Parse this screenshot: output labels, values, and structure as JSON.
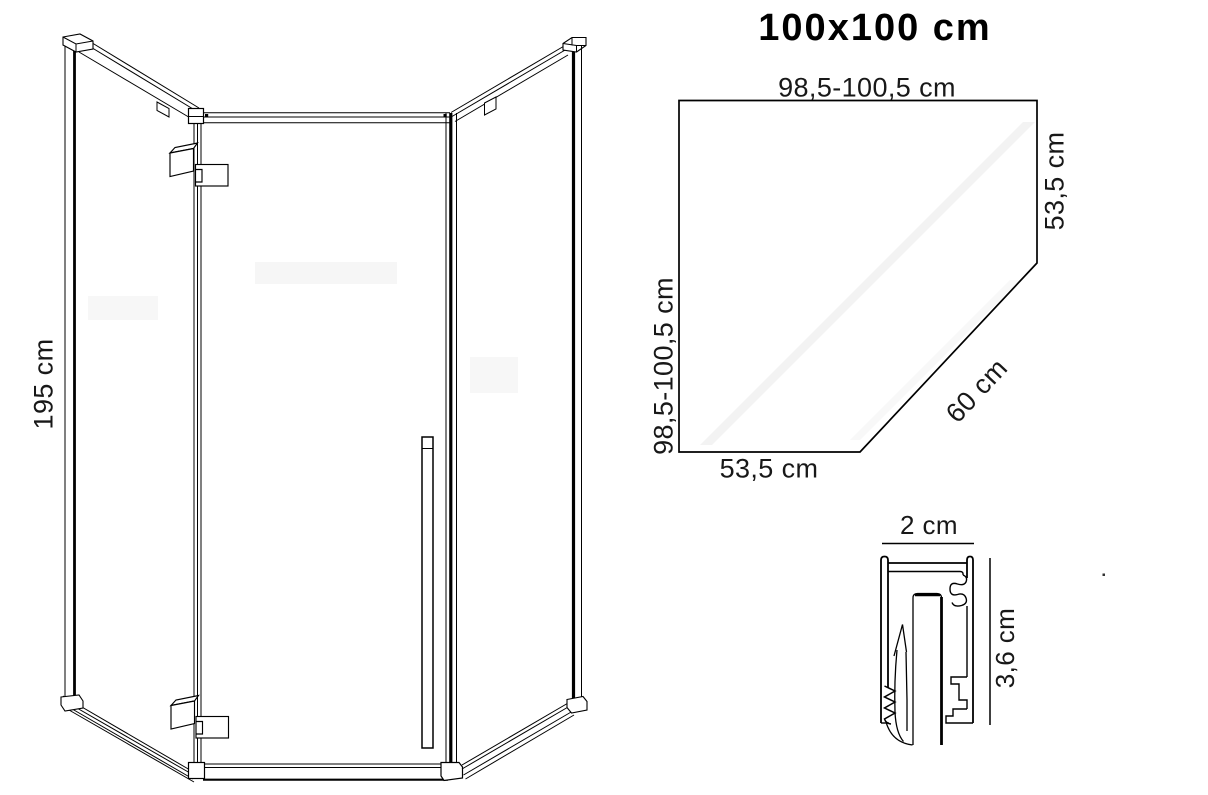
{
  "title": "100x100 cm",
  "side_view": {
    "height_label": "195 cm"
  },
  "floor_plan": {
    "width_top": "98,5-100,5 cm",
    "depth_left": "98,5-100,5 cm",
    "side_right": "53,5 cm",
    "door_diagonal": "60 cm",
    "side_bottom": "53,5 cm"
  },
  "profile": {
    "width": "2 cm",
    "depth": "3,6 cm"
  },
  "colors": {
    "line": "#000000",
    "text": "#181818",
    "background": "#ffffff",
    "glass_reflection": "#f3f3f3"
  }
}
